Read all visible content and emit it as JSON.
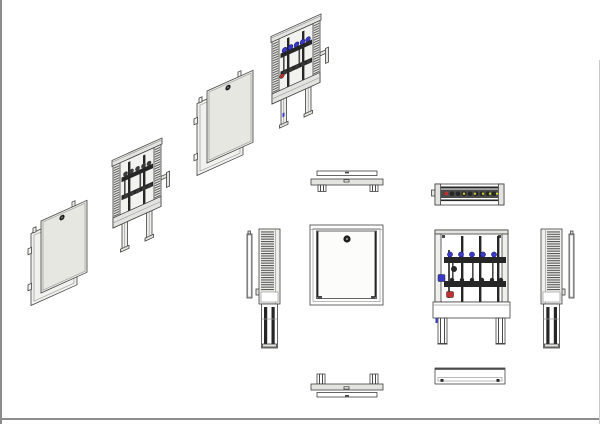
{
  "document": {
    "type": "technical-drawing",
    "subject": "manifold-cabinet-assembly-views",
    "background": "#ffffff"
  },
  "colors": {
    "border": "#8d8d8d",
    "line": "#3f3f3f",
    "blue": "#3a3ac8",
    "red": "#c03030",
    "yellow": "#cfcf30",
    "panel": "#e7e7e2",
    "dark": "#262626"
  },
  "views": {
    "iso_door_front": "isometric exploded door and frame",
    "iso_cabinet_mono": "isometric cabinet with manifold",
    "iso_door_cover": "isometric door cover panel",
    "iso_cabinet_color": "isometric open cabinet with valved manifold",
    "top_frame": "top view of cabinet frame",
    "top_manifold": "top view of cabinet with manifold",
    "side_left": "left side view",
    "front_closed": "front view closed cabinet",
    "front_manifold": "front view cabinet with manifold",
    "side_right": "right side view",
    "bottom_frame": "bottom view of cabinet frame",
    "bottom_panel": "bottom view of cover panel"
  }
}
